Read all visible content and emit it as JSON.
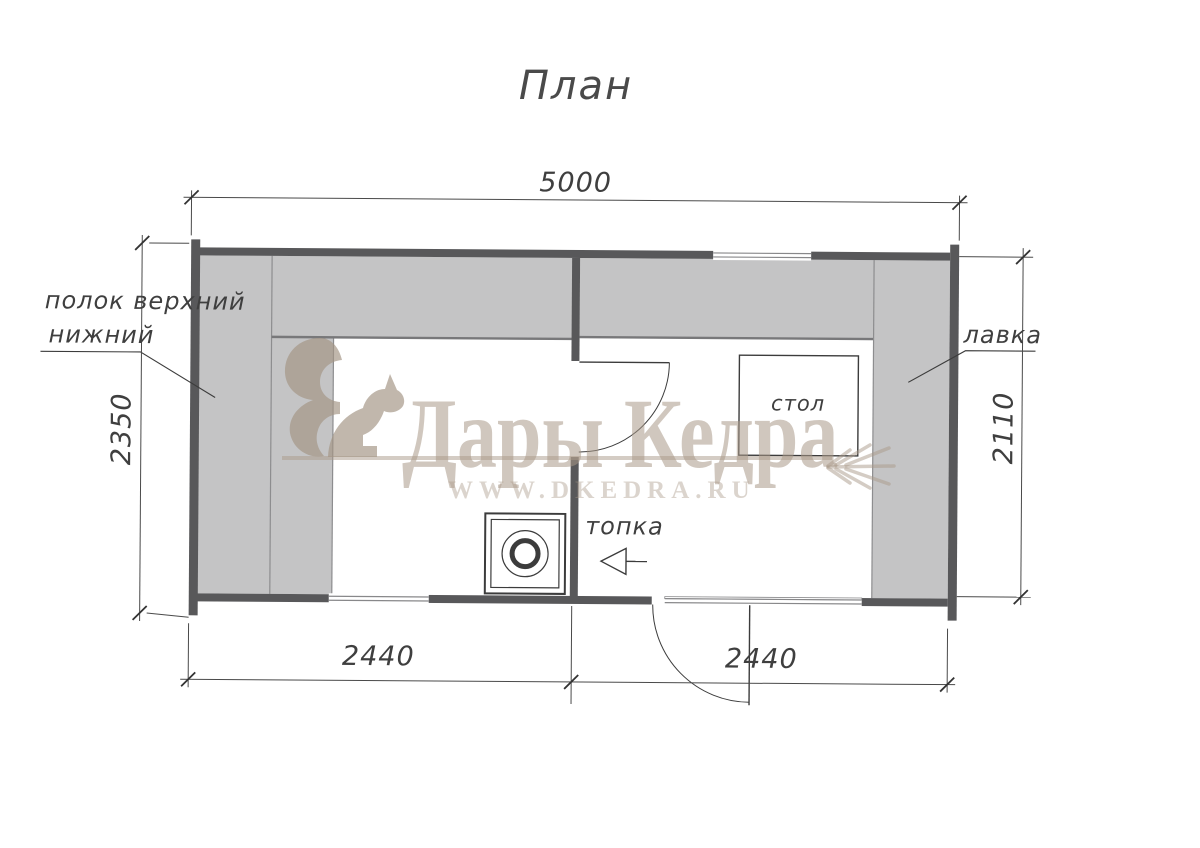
{
  "title": "План",
  "dimensions": {
    "top": "5000",
    "left": "2350",
    "right": "2110",
    "bottom_left": "2440",
    "bottom_right": "2440"
  },
  "labels": {
    "shelf_upper": "полок верхний",
    "shelf_lower": "нижний",
    "bench": "лавка",
    "table": "стол",
    "firebox": "топка"
  },
  "watermark": {
    "brand": "Дары Кедра",
    "website": "WWW.DKEDRA.RU"
  },
  "colors": {
    "wall": "#58585a",
    "furniture": "#c4c4c5",
    "line": "#3c3c3c",
    "watermark_beige": "#a99989"
  }
}
